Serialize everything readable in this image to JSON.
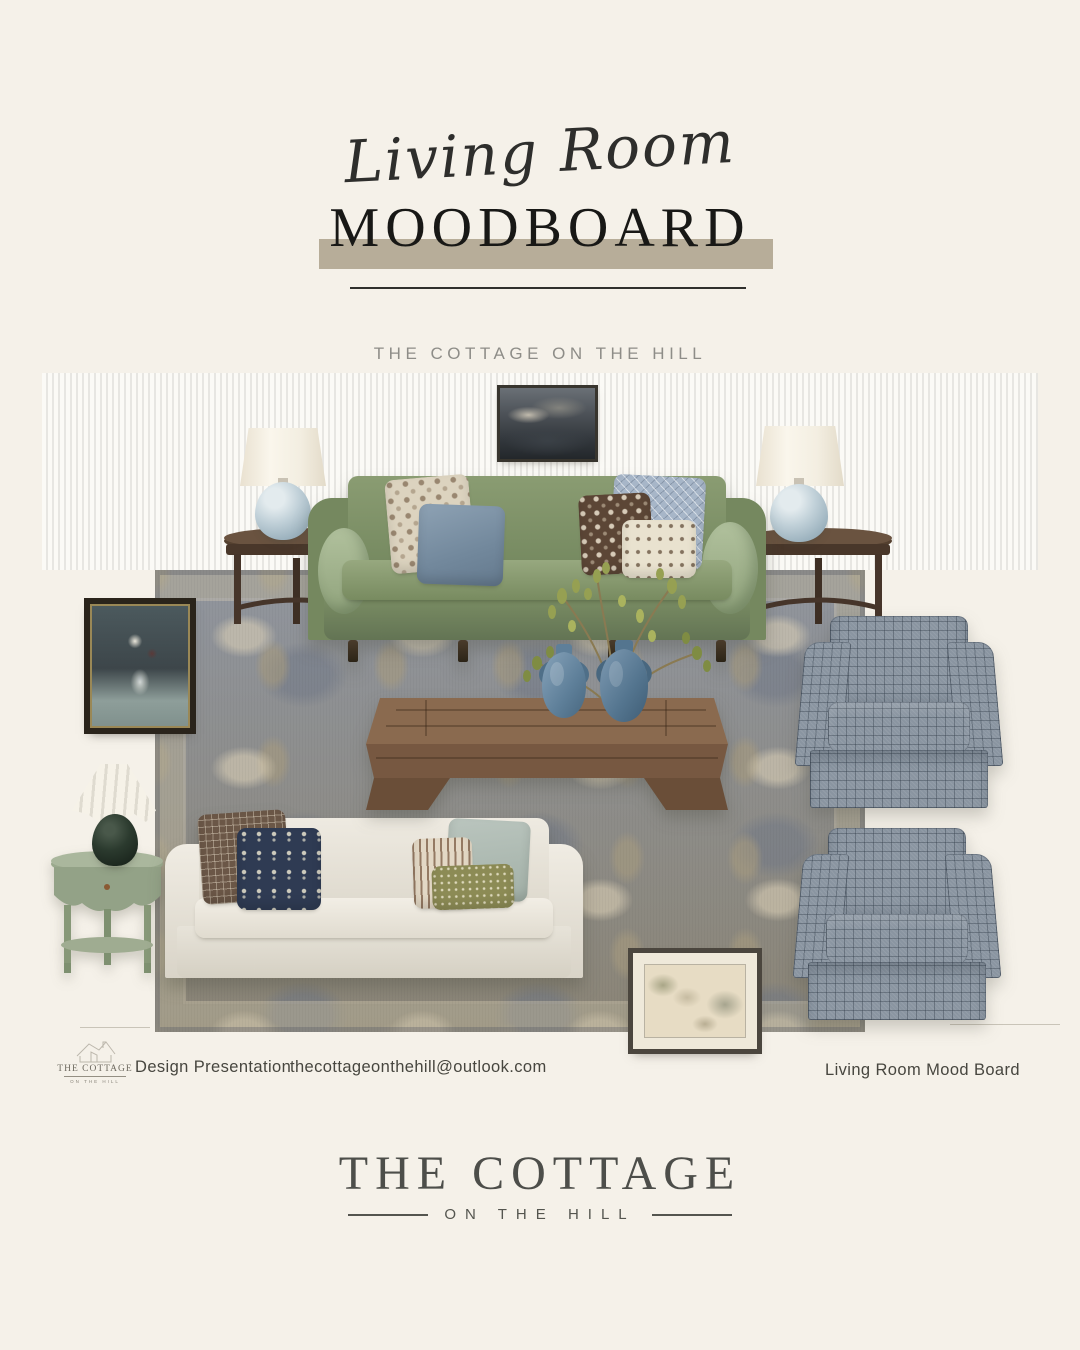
{
  "header": {
    "script_title": "Living Room",
    "title": "MOODBOARD",
    "subtitle": "THE COTTAGE ON THE HILL"
  },
  "footer": {
    "logo_name": "THE COTTAGE",
    "logo_tagline": "ON THE HILL",
    "presentation_label": "Design Presentation",
    "email": "thecottageonthehill@outlook.com",
    "board_label": "Living Room Mood Board"
  },
  "brand": {
    "name": "THE COTTAGE",
    "tagline": "ON THE HILL"
  },
  "palette": {
    "background": "#f5f1e9",
    "banner_tan": "#b7ad99",
    "ink": "#181816",
    "subtitle_gray": "#8e8d88",
    "sofa_green": "#7b8e63",
    "sage_pillow": "#a9bc97",
    "slate_blue_pillow": "#8094a6",
    "rug_blue_gray": "#8d929b",
    "rug_tan": "#a3967a",
    "chair_check_gray": "#8a95a1",
    "dark_wood": "#54402f",
    "coffee_table_wood": "#7c5f46",
    "vase_blue": "#6b8ba3",
    "side_table_sage": "#97a68b",
    "cream_sofa": "#e8e4db",
    "navy_pillow": "#2f3b53"
  }
}
